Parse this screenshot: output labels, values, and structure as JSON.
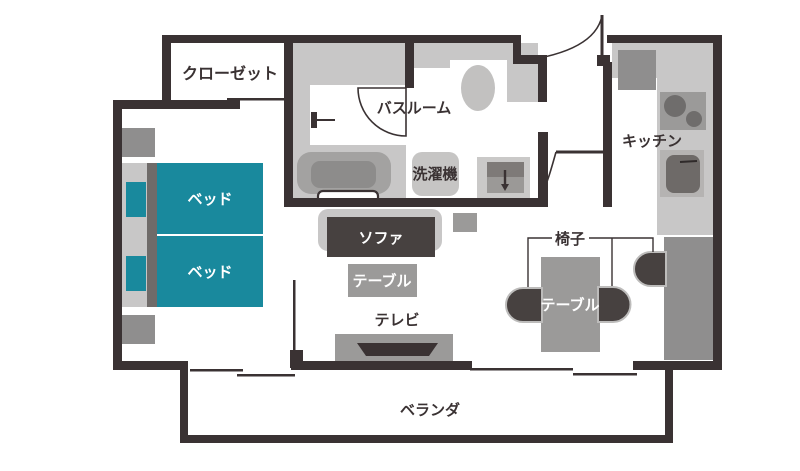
{
  "floorplan": {
    "type": "apartment-floor-plan",
    "labels": {
      "closet": "クローゼット",
      "bathroom": "バスルーム",
      "washing_machine": "洗濯機",
      "kitchen": "キッチン",
      "bed1": "ベッド",
      "bed2": "ベッド",
      "sofa": "ソファ",
      "living_table": "テーブル",
      "tv": "テレビ",
      "chair": "椅子",
      "dining_table": "テーブル",
      "veranda": "ベランダ"
    },
    "colors": {
      "wall": "#3a3233",
      "bed_teal": "#19899d",
      "floor_light_gray": "#c8c7c7",
      "furniture_mid_gray": "#9b9a99",
      "furniture_dark": "#474140",
      "text_dark": "#3a3233",
      "text_white": "#ffffff"
    }
  }
}
